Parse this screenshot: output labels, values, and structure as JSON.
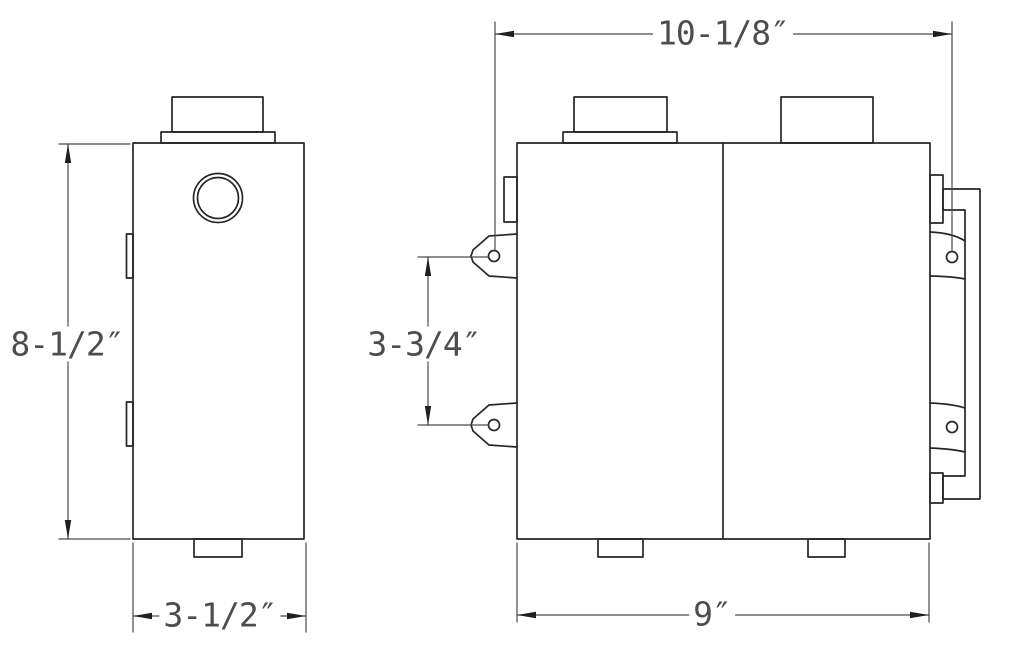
{
  "page": {
    "background": "#ffffff",
    "object_line_color": "#262626",
    "dimension_line_color": "#4a4a4a",
    "text_color": "#4d4d4d"
  },
  "drawing": {
    "views": {
      "side_view": {
        "dims": {
          "height": "8-1/2″",
          "width": "3-1/2″"
        }
      },
      "front_view": {
        "dims": {
          "overall_width": "10-1/8″",
          "body_width": "9″",
          "tab_hole_spacing": "3-3/4″"
        }
      }
    }
  }
}
